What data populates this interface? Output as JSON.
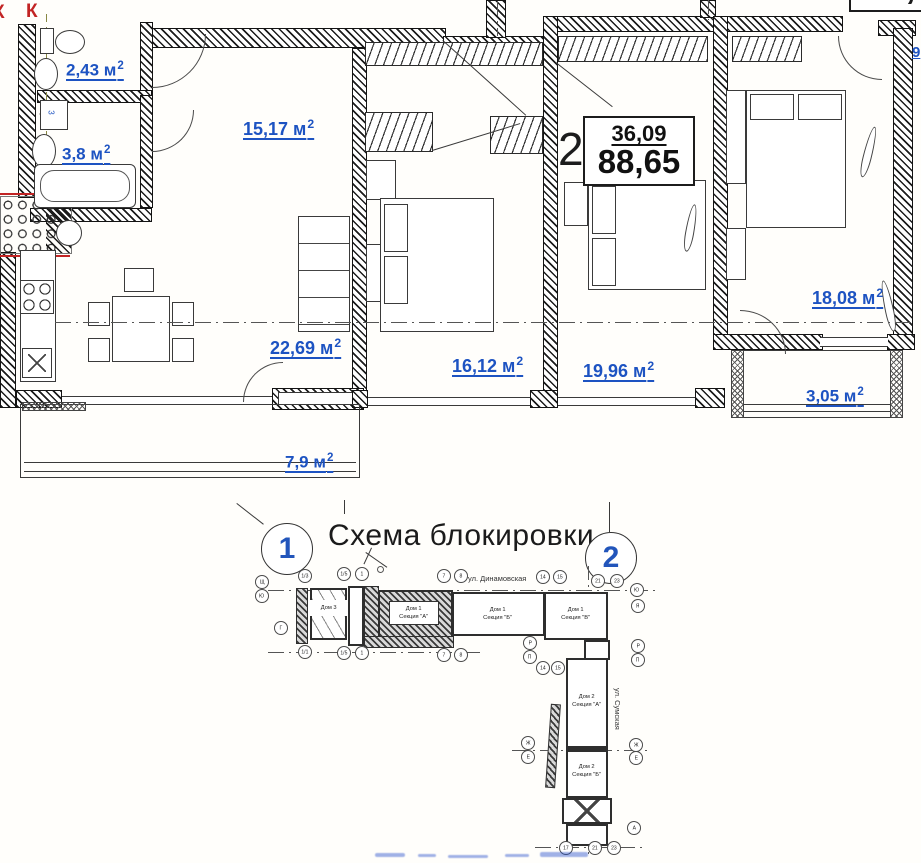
{
  "plan": {
    "rooms": [
      {
        "text": "2,43 м",
        "sup": "2"
      },
      {
        "text": "3,8 м",
        "sup": "2"
      },
      {
        "text": "15,17 м",
        "sup": "2"
      },
      {
        "text": "22,69 м",
        "sup": "2"
      },
      {
        "text": "16,12 м",
        "sup": "2"
      },
      {
        "text": "19,96 м",
        "sup": "2"
      },
      {
        "text": "18,08 м",
        "sup": "2"
      },
      {
        "text": "3,05 м",
        "sup": "2"
      },
      {
        "text": "7,9 м",
        "sup": "2"
      }
    ],
    "apartment_number": "2",
    "info_box": {
      "living_area": "36,09",
      "total_area": "88,65"
    },
    "clipped_area_top_right": "82,69",
    "clipped_label_right_edge": "9",
    "riser_label_left": "К",
    "riser_label_right": "К",
    "washer_label": "3",
    "colors": {
      "area_label_blue": "#1d53c2",
      "riser_red": "#c22424"
    }
  },
  "scheme": {
    "title": "Схема блокировки",
    "section_marker_1": "1",
    "section_marker_2": "2",
    "street_top": "ул. Динамовская",
    "street_right": "ул. Сумская",
    "buildings": [
      {
        "name": "Дом 3",
        "section": ""
      },
      {
        "name": "Дом 1",
        "section": "Секция \"А\""
      },
      {
        "name": "Дом 1",
        "section": "Секция \"Б\""
      },
      {
        "name": "Дом 1",
        "section": "Секция \"В\""
      },
      {
        "name": "Дом 2",
        "section": "Секция \"А\""
      },
      {
        "name": "Дом 2",
        "section": "Секция \"Б\""
      }
    ],
    "axis_markers": [
      "Щ",
      "Ю",
      "1/3",
      "1/5",
      "1",
      "7",
      "8",
      "14",
      "15",
      "21",
      "23",
      "Г",
      "1/1",
      "1/5",
      "1",
      "7",
      "8",
      "Р",
      "П",
      "14",
      "15",
      "Р",
      "П",
      "Ю",
      "Я",
      "Ж",
      "Е",
      "Ж",
      "Е",
      "17",
      "21",
      "23",
      "А"
    ]
  }
}
